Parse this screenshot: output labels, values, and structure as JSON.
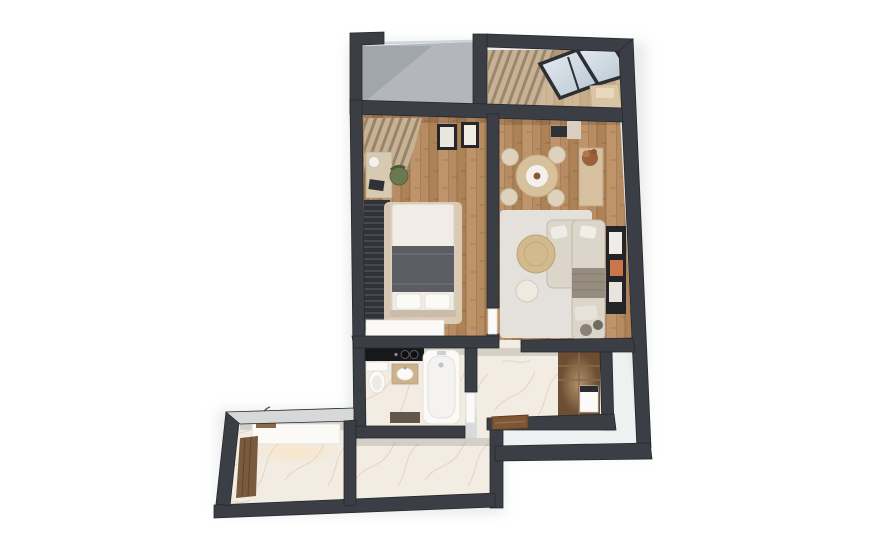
{
  "scene": {
    "kind": "3d-isometric-floorplan-render",
    "description": "Top-down 3D cutaway render of a one-bedroom apartment on a white background. No text labels are visible in the image.",
    "background": "#ffffff"
  },
  "palette": {
    "bg": "#ffffff",
    "wall": "#3b3e44",
    "wall-edge": "#26282d",
    "wall-light": "#d7d8da",
    "grey-floor": "#b3b7bc",
    "white-floor": "#eef0f2",
    "marble": "#f2ece3",
    "marble-vein": "#d5c3a6",
    "wood-a": "#b78c62",
    "wood-b": "#aa7e53",
    "wood-c": "#c49a70",
    "wood-light-a": "#cfb797",
    "wood-light-b": "#c2a883",
    "curtain-a": "#c7b296",
    "curtain-b": "#99846a",
    "glass-a": "#e7edf2",
    "glass-b": "#b6c5d1",
    "rug-grey": "#e4e1dc",
    "rug-beige": "#dccdb8",
    "bed-white": "#f1ede6",
    "blanket": "#5b5d62",
    "sofa": "#dbd5ca",
    "sofa-edge": "#c2bbad",
    "throw": "#968d80",
    "table-wood": "#d7c09c",
    "coffee-wood": "#d3b98e",
    "chair-beige": "#ded2bd",
    "chair-green": "#6b7850",
    "dark-furniture": "#2f3237",
    "cabinet-wood": "#6d4e33",
    "cabinet-shelf": "#8a6a47",
    "door-brown": "#7d5634",
    "white-furn": "#fbfaf7",
    "glow": "#ffdfae",
    "shadow": "#9aa0a6"
  },
  "rooms": [
    {
      "id": "open-balcony",
      "floor": "grey-concrete",
      "furniture": []
    },
    {
      "id": "glazed-loggia",
      "floor": "light-wood",
      "furniture": [
        "curtains",
        "tilted-glazing-panel",
        "tilted-glazing-panel",
        "bench"
      ]
    },
    {
      "id": "bedroom",
      "floor": "wood-planks",
      "furniture": [
        "corner-curtains",
        "desk",
        "desk-lamp",
        "green-chair",
        "slatted-wardrobe",
        "area-rug",
        "double-bed",
        "pillows",
        "grey-blanket",
        "wall-frame",
        "wall-frame",
        "low-dresser"
      ]
    },
    {
      "id": "living-room",
      "floor": "wood-planks",
      "furniture": [
        "round-dining-table",
        "dining-chair",
        "dining-chair",
        "dining-chair",
        "dining-chair",
        "wall-console",
        "sideboard",
        "potted-plant",
        "area-rug",
        "corner-sofa",
        "throw-blanket",
        "round-coffee-table",
        "side-table",
        "pouf",
        "pouf",
        "wall-niche-with-art"
      ]
    },
    {
      "id": "bathroom",
      "floor": "marble",
      "furniture": [
        "black-counter-with-hob-knobs",
        "toilet",
        "vanity-sink",
        "bathtub",
        "bath-mat"
      ]
    },
    {
      "id": "hallway",
      "floor": "marble",
      "furniture": [
        "built-in-wardrobe",
        "washer-appliance",
        "entrance-door"
      ]
    },
    {
      "id": "entry-hall",
      "floor": "marble",
      "furniture": [
        "floating-console-with-underlight",
        "decor-shelf",
        "vase",
        "wood-accent-panel"
      ]
    },
    {
      "id": "common-area-outside-unit",
      "floor": "white",
      "furniture": []
    }
  ]
}
